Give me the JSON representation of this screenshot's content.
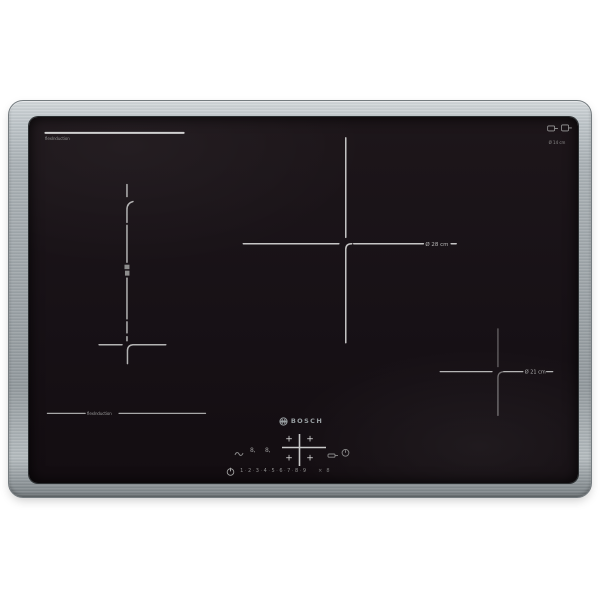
{
  "scene": {
    "background_color": "#ffffff"
  },
  "cooktop": {
    "frame_color": "#9aa1a5",
    "glass_color": "#181216",
    "marking_color": "#bdbdbd"
  },
  "brand": {
    "logo_icon": "bosch-anchor-icon",
    "name": "BOSCH"
  },
  "glass_print": {
    "top_left_zone_label": "flexInduction",
    "bottom_left_zone_label": "flexInduction",
    "center_zone_diameter": "Ø 28 cm",
    "right_zone_diameter": "Ø 21 cm",
    "top_right_caption": "Ø 14 cm"
  },
  "control_panel": {
    "zone_selector_plus": "+",
    "timer_display_left": "8,",
    "timer_display_right": "8,",
    "power_levels": [
      "1",
      "2",
      "3",
      "4",
      "5",
      "6",
      "7",
      "8",
      "9"
    ],
    "level_separator": "·",
    "extra_keys": [
      "×",
      "8"
    ],
    "icons": {
      "power": "power-icon",
      "wipe_protection": "wipe-protection-icon",
      "frying_sensor": "frying-sensor-icon",
      "timer": "timer-icon",
      "pan_marks": "pan-icon"
    }
  }
}
